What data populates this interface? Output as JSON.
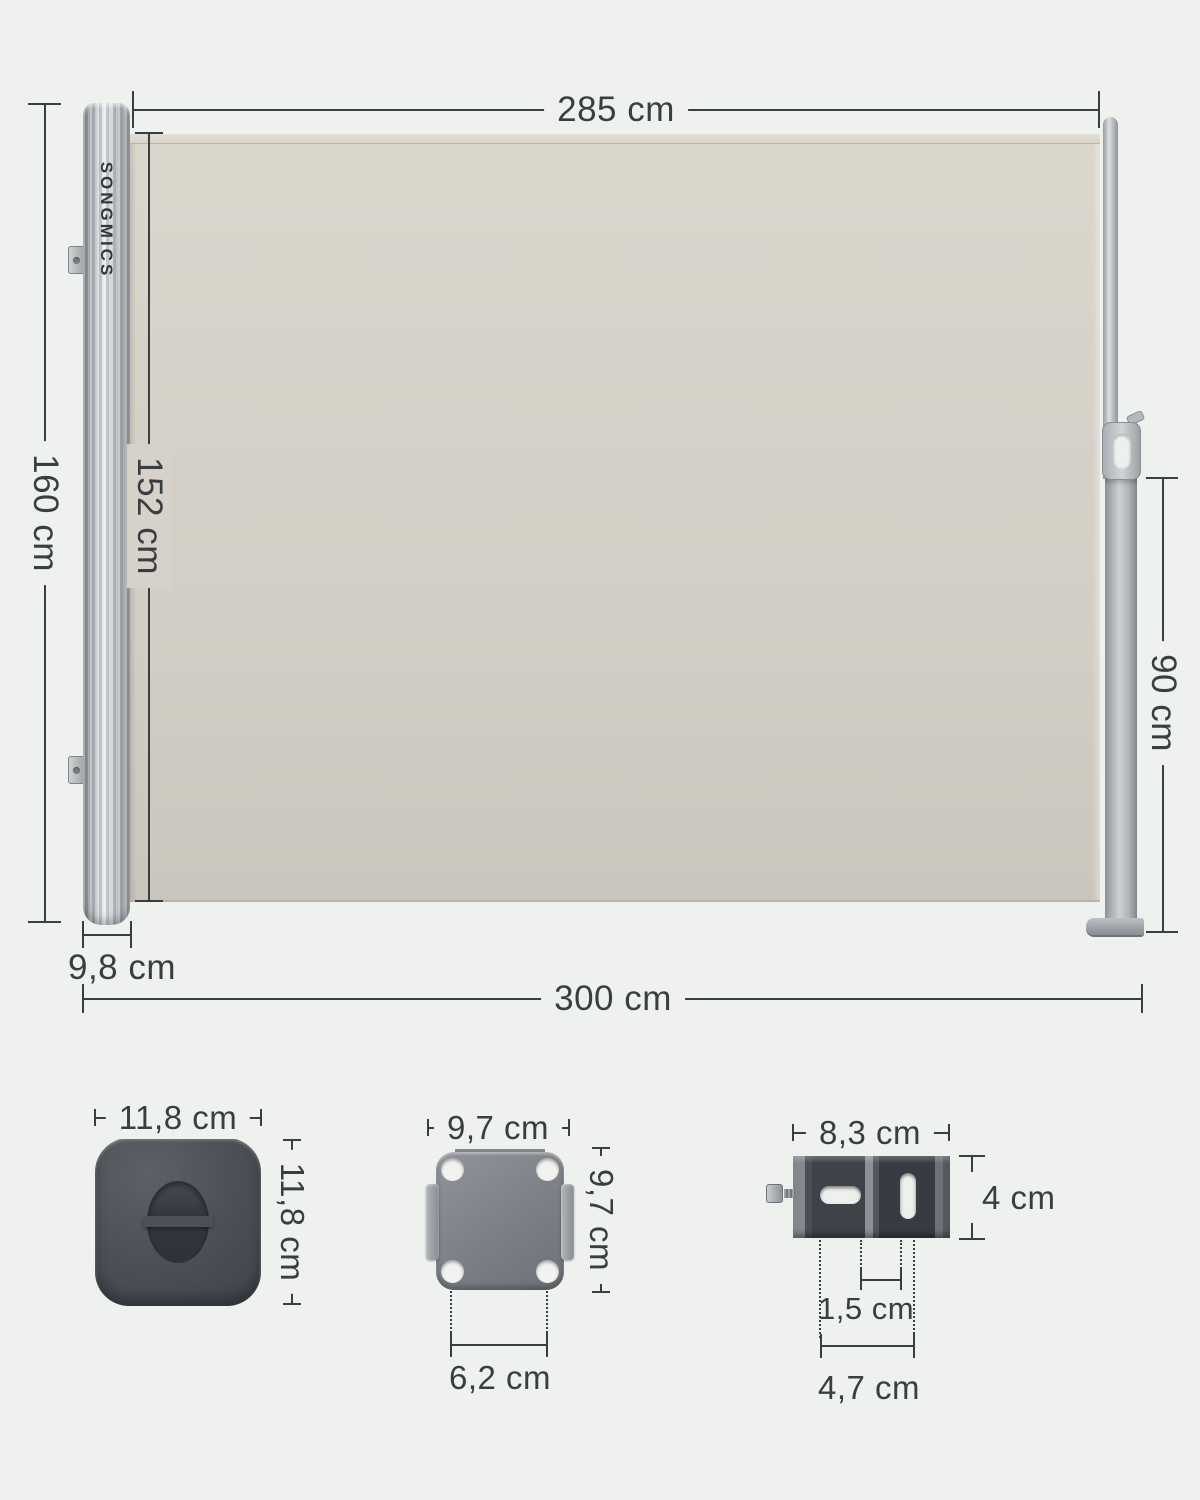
{
  "brand": "SONGMICS",
  "colors": {
    "background": "#eff1ee",
    "dimension_line": "#3a3e42",
    "fabric": "#d6d2c9",
    "metal_light": "#d9dcde",
    "metal_dark": "#888d92",
    "part_dark_gray": "#44484e"
  },
  "dims": {
    "top_width": "285 cm",
    "total_height": "160 cm",
    "fabric_height": "152 cm",
    "pull_pole_height": "90 cm",
    "cassette_depth": "9,8 cm",
    "total_width": "300 cm"
  },
  "parts": {
    "end_cap": {
      "width": "11,8 cm",
      "height": "11,8 cm"
    },
    "floor_plate": {
      "width": "9,7 cm",
      "height": "9,7 cm",
      "hole_spacing": "6,2 cm"
    },
    "wall_bracket": {
      "width": "8,3 cm",
      "height": "4 cm",
      "slot_gap": "1,5 cm",
      "hole_spacing": "4,7 cm"
    }
  }
}
